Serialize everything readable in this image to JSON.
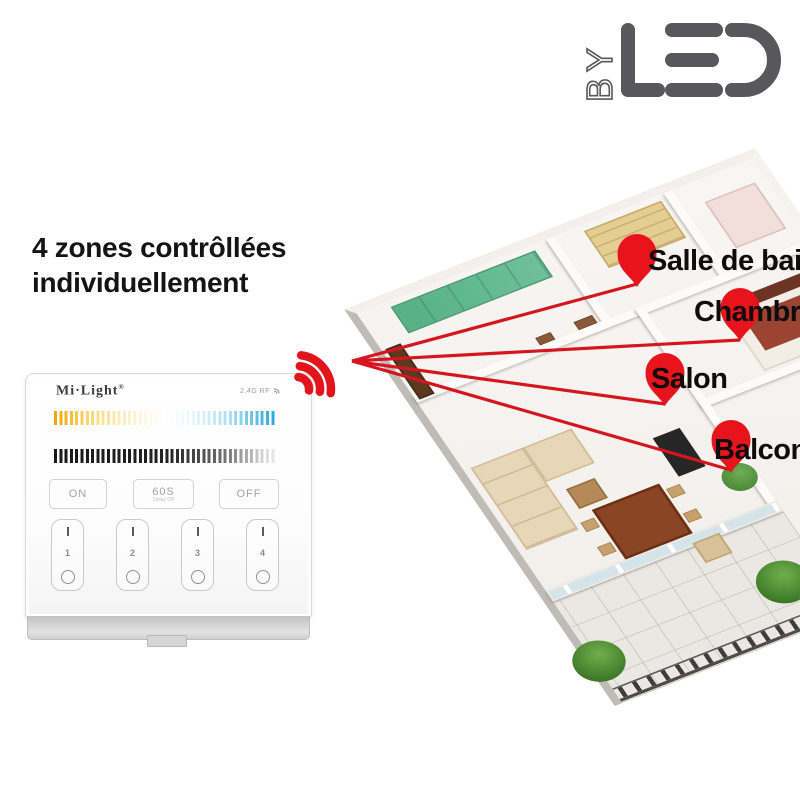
{
  "logo": {
    "by": "BY",
    "led": "LED",
    "alt": "BYLED"
  },
  "headline": {
    "line1": "4 zones contrôllées",
    "line2": "individuellement"
  },
  "remote": {
    "brand": "Mi·Light",
    "reg": "®",
    "rf_label": "2.4G RF",
    "buttons": {
      "on": "ON",
      "timer": "60S",
      "timer_sub": "Delay Off",
      "off": "OFF"
    },
    "zones": [
      {
        "number": "1"
      },
      {
        "number": "2"
      },
      {
        "number": "3"
      },
      {
        "number": "4"
      }
    ]
  },
  "map": {
    "labels": [
      {
        "id": "salle-de-bain",
        "text": "Salle de bain"
      },
      {
        "id": "chambre",
        "text": "Chambre"
      },
      {
        "id": "salon",
        "text": "Salon"
      },
      {
        "id": "balcon",
        "text": "Balcon"
      }
    ]
  },
  "colors": {
    "accent_red": "#e2141c",
    "logo_gray": "#58585a",
    "warm_end": "#f2a400",
    "cool_end": "#2ba6db"
  }
}
